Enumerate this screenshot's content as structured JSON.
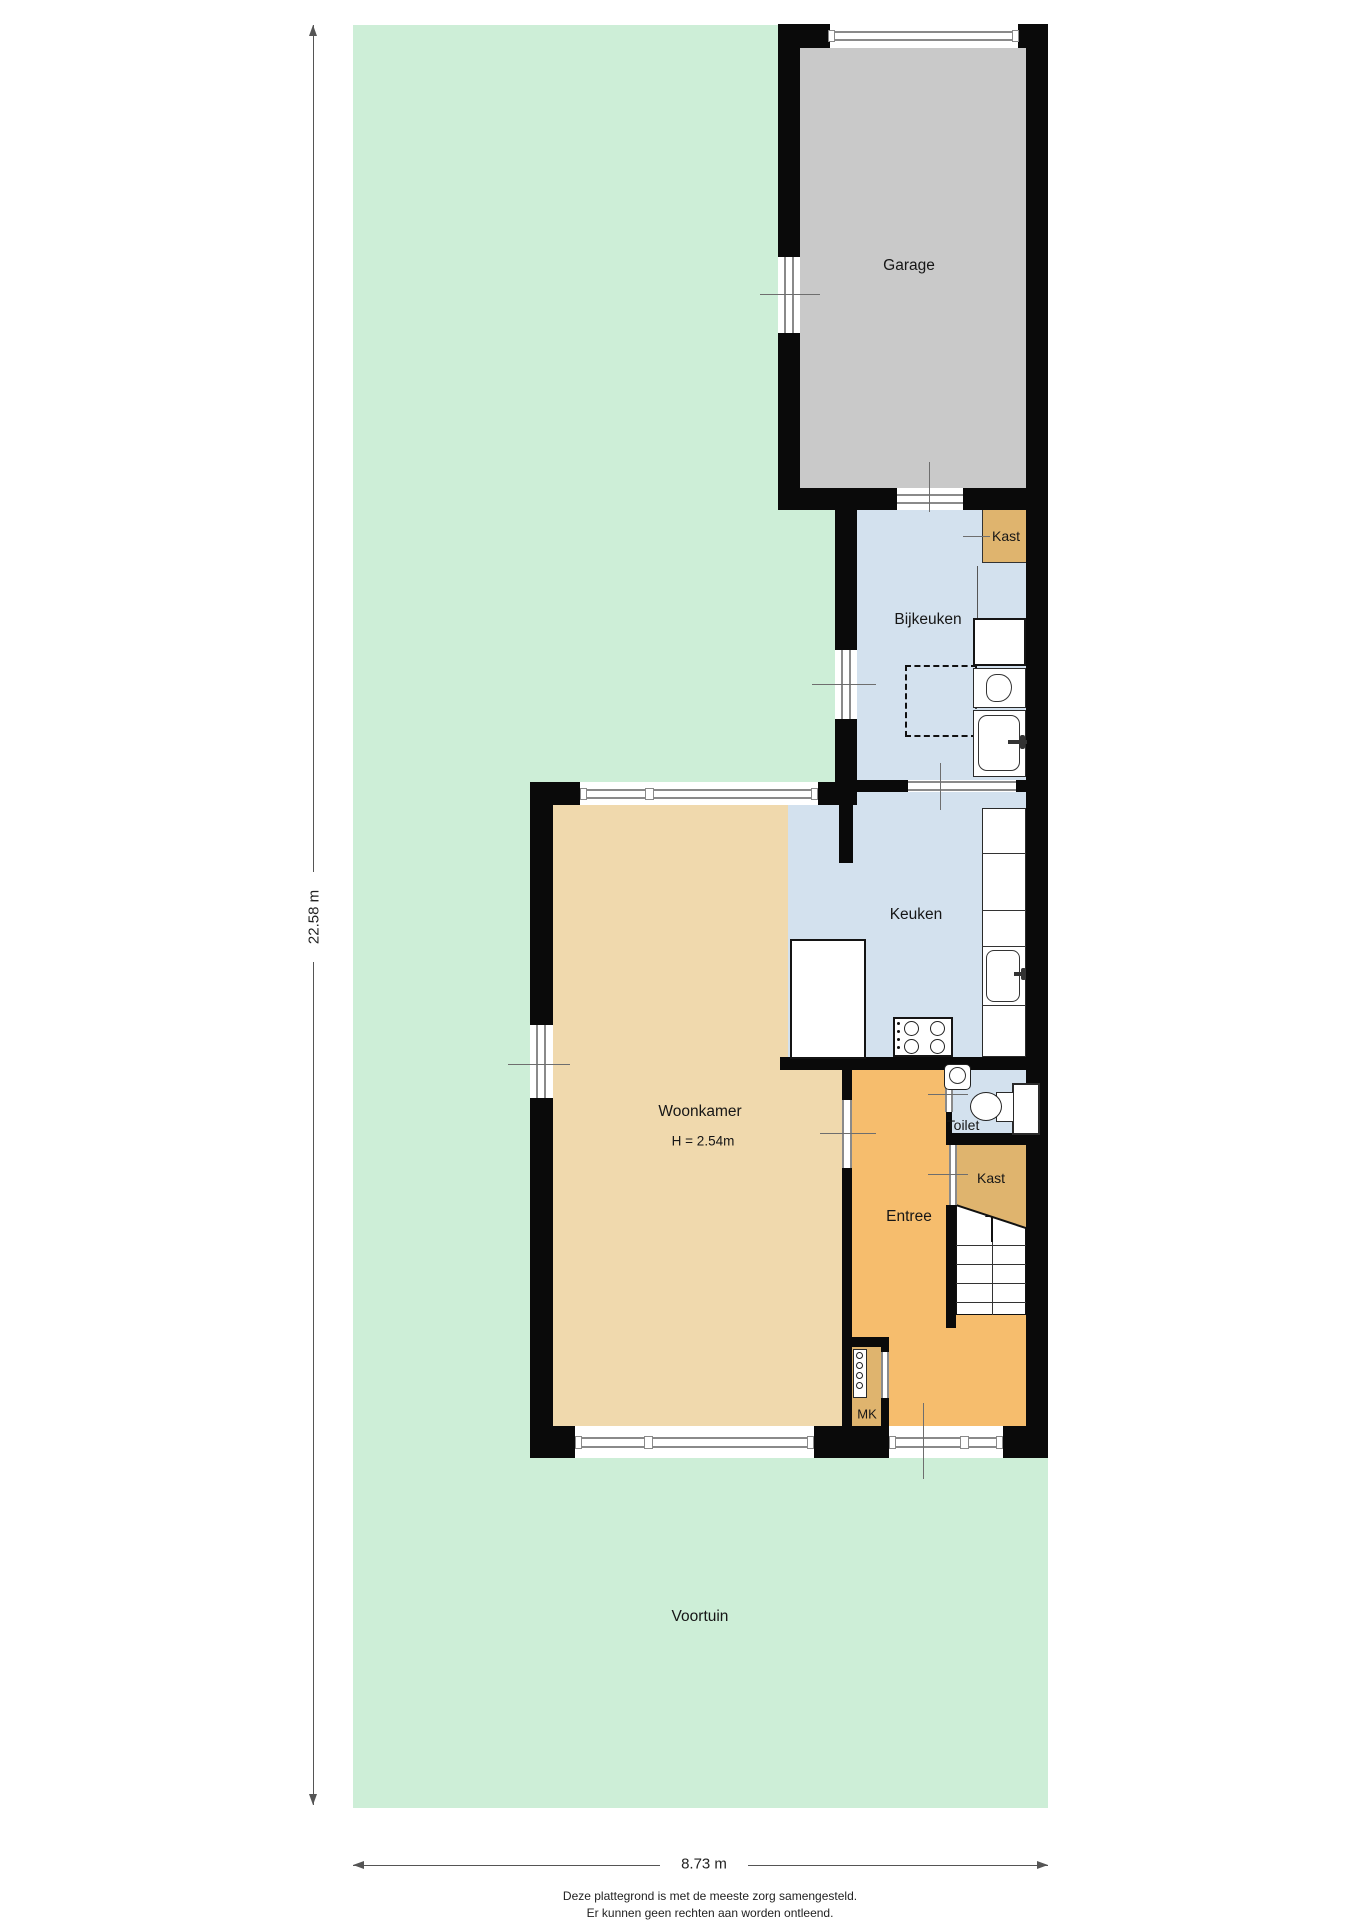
{
  "rooms": {
    "garage": "Garage",
    "bijkeuken": "Bijkeuken",
    "kast_bijkeuken": "Kast",
    "keuken": "Keuken",
    "woonkamer": "Woonkamer",
    "woonkamer_height": "H = 2.54m",
    "toilet": "Toilet",
    "kast_entree": "Kast",
    "entree": "Entree",
    "mk": "MK",
    "voortuin": "Voortuin"
  },
  "dimensions": {
    "plot_height": "22.58 m",
    "plot_width": "8.73 m"
  },
  "footer": {
    "line1": "Deze plattegrond is met de meeste zorg samengesteld.",
    "line2": "Er kunnen geen rechten aan worden ontleend."
  },
  "colors": {
    "garden": "#cdeed7",
    "garage": "#c9c9c9",
    "wet": "#d3e1ee",
    "living": "#f0d9ad",
    "hall": "#f6bd6d",
    "closet": "#dfb46e",
    "wall": "#0a0a0a",
    "line": "#8a8a8a"
  }
}
